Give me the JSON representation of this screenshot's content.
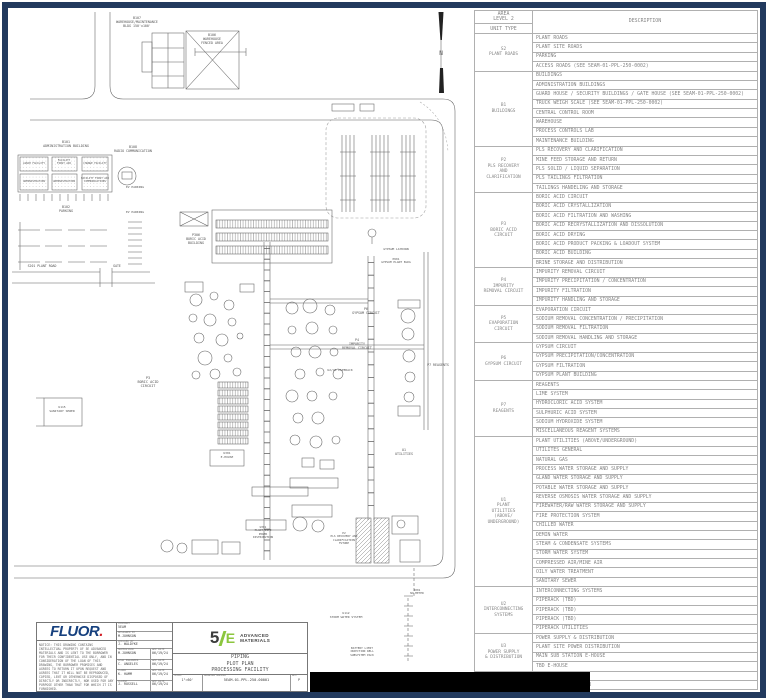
{
  "colors": {
    "frame_navy": "#223a5e",
    "fluor_blue": "#16407e",
    "fluor_red": "#d22027",
    "brand_green": "#8cc63e",
    "line_gray": "#5f5f5f",
    "table_text": "#858585",
    "redaction_black": "#000000"
  },
  "area_table": {
    "header": {
      "area_level": "AREA\nLEVEL 2",
      "unit_type": "UNIT TYPE",
      "description": "DESCRIPTION"
    },
    "groups": [
      {
        "unit": "S2\nPLANT ROADS",
        "rows": [
          "PLANT ROADS",
          "PLANT SITE ROADS",
          "PARKING",
          "ACCESS ROADS (SEE 5EAM-01-PPL-250-0002)"
        ]
      },
      {
        "unit": "B1\nBUILDINGS",
        "rows": [
          "BUILDINGS",
          "ADMINISTRATION BUILDINGS",
          "GUARD HOUSE / SECURITY BUILDINGS / GATE HOUSE (SEE 5EAM-01-PPL-250-0002)",
          "TRUCK WEIGH SCALE (SEE 5EAM-01-PPL-250-0002)",
          "CENTRAL CONTROL ROOM",
          "WAREHOUSE",
          "PROCESS CONTROLS LAB",
          "MAINTENANCE BUILDING"
        ]
      },
      {
        "unit": "P2\nPLS RECOVERY\nAND\nCLARIFICATION",
        "rows": [
          "PLS RECOVERY AND CLARIFICATION",
          "MINE FEED STORAGE AND RETURN",
          "PLS SOLID / LIQUID SEPARATION",
          "PLS TAILINGS FILTRATION",
          "TAILINGS HANDELING AND STORAGE"
        ]
      },
      {
        "unit": "P3\nBORIC ACID\nCIRCUIT",
        "rows": [
          "BORIC ACID CIRCUIT",
          "BORIC ACID CRYSTALLIZATION",
          "BORIC ACID FILTRATION AND WASHING",
          "BORIC ACID RECRYSTALLIZATION AND DISSOLUTION",
          "BORIC ACID DRYING",
          "BORIC ACID PRODUCT PACKING & LOADOUT SYSTEM",
          "BORIC ACID BUILDING",
          "BRINE STORAGE AND DISTRIBUTION"
        ]
      },
      {
        "unit": "P4\nIMPURITY\nREMOVAL CIRCUIT",
        "rows": [
          "IMPURITY REMOVAL CIRCUIT",
          "IMPURITY PRECIPITATION / CONCENTRATION",
          "IMPURITY FILTRATION",
          "IMPURITY HANDLING AND STORAGE"
        ]
      },
      {
        "unit": "P5\nEVAPORATION\nCIRCUIT",
        "rows": [
          "EVAPORATION CIRCUIT",
          "SODIUM REMOVAL CONCENTRATION / PRECIPITATION",
          "SODIUM REMOVAL FILTRATION",
          "SODIUM REMOVAL HANDLING AND STORAGE"
        ]
      },
      {
        "unit": "P6\nGYPSUM CIRCUIT",
        "rows": [
          "GYPSUM CIRCUIT",
          "GYPSUM PRECIPITATION/CONCENTRATION",
          "GYPSUM FILTRATION",
          "GYPSUM PLANT BUILDING"
        ]
      },
      {
        "unit": "P7\nREAGENTS",
        "rows": [
          "REAGENTS",
          "LIME SYSTEM",
          "HYDROCLORIC ACID SYSTEM",
          "SULPHURIC ACID SYSTEM",
          "SODIUM HYDROXIDE SYSTEM",
          "MISCELLANEOUS REAGENT SYSTEMS"
        ]
      },
      {
        "unit": "U1\nPLANT\nUTILITIES\n(ABOVE/\nUNDERGROUND)",
        "rows": [
          "PLANT UTILITIES (ABOVE/UNDERGROUND)",
          "UTILITES GENERAL",
          "NATURAL GAS",
          "PROCESS WATER STORAGE AND SUPPLY",
          "GLAND WATER STORAGE AND SUPPLY",
          "POTABLE WATER STORAGE AND SUPPLY",
          "REVERSE OSMOSIS WATER STORAGE AND SUPPLY",
          "FIREWATER/RAW WATER STORAGE AND SUPPLY",
          "FIRE PROTECTION SYSTEM",
          "CHILLED WATER",
          "DEMIN WATER",
          "STEAM & CONDENSATE SYSTEMS",
          "STORM WATER SYSTEM",
          "COMPRESSED AIR/MINE AIR",
          "OILY WATER TREATMENT",
          "SANITARY SEWER"
        ]
      },
      {
        "unit": "U2\nINTERCONNECTING\nSYSTEMS",
        "rows": [
          "INTERCONNECTING SYSTEMS",
          "PIPERACK (TBD)",
          "PIPERACK (TBD)",
          "PIPERACK (TBD)",
          "PIPERACK UTILITIES"
        ]
      },
      {
        "unit": "U3\nPOWER SUPPLY\n& DISTRIBUTION",
        "rows": [
          "POWER SUPPLY & DISTRIBUTION",
          "PLANT SITE POWER DISTRIBUTION",
          "MAIN SUB STATION E-HOUSE",
          "TBD E-HOUSE"
        ]
      },
      {
        "unit": "U4\nCOMMUNICATIONS",
        "rows": [
          "COMMUNICATIONS",
          "RADIO COMMUNICATION"
        ]
      }
    ]
  },
  "title_block": {
    "fluor_logo": "FLUOR",
    "fluor_dot": ".",
    "notice": "NOTICE: THIS DRAWING CONTAINS INTELLECTUAL PROPERTY OF 5E ADVANCED MATERIALS AND IS LENT TO THE BORROWER FOR THEIR CONFIDENTIAL USE ONLY, AND IN CONSIDERATION OF THE LOAN OF THIS DRAWING, THE BORROWER PROMISES AND AGREES TO RETURN IT UPON REQUEST AND AGREES THAT IT WILL NOT BE REPRODUCED, COPIED, LENT OR OTHERWISE DISPOSED OF DIRECTLY OR INDIRECTLY, NOR USED FOR ANY PURPOSE OTHER THAN THAT FOR WHICH IT IS FURNISHED.",
    "contract_label": "CONTRACT",
    "contract": "5EAM",
    "designed_label": "DESIGNED BY",
    "designed": "M.JOHNSON",
    "checked_label": "CHECKED BY",
    "checked": "J. WALDYKE",
    "approvals": [
      {
        "role": "SUPERVISOR",
        "name": "M.JOHNSON",
        "date_label": "APP DATE",
        "date": "06/19/24"
      },
      {
        "role": "LEAD ENGINEER",
        "name": "C. ANGELES",
        "date_label": "APP DATE",
        "date": "06/19/24"
      },
      {
        "role": "FLUOR",
        "name": "K. HAMM",
        "date_label": "APP DATE",
        "date": "06/19/24"
      },
      {
        "role": "CLIENT",
        "name": "J. RUSSELL",
        "date_label": "APP DATE",
        "date": "06/19/24"
      }
    ],
    "brand_5": "5",
    "brand_e": "E",
    "brand_name": "ADVANCED\nMATERIALS",
    "title_lines": "PIPING\nPLOT PLAN\nPROCESSING FACILITY",
    "scale_label": "SCALE",
    "scale": "1\"=60'",
    "dwg_label": "DRAWING NUMBER",
    "dwg": "5EAM-01-PPL-250-00001",
    "rev_label": "REV",
    "rev": "P"
  },
  "plot_plan": {
    "labels": [
      {
        "t": "B107\nWAREHOUSE/MAINTENANCE\nBLDG 150'x100'",
        "x": 137,
        "y": 17,
        "fs": 3.3
      },
      {
        "t": "B106\nWAREHOUSE\nFENCED AREA",
        "x": 212,
        "y": 34,
        "fs": 3.3
      },
      {
        "t": "B101\nADMINISTRATION BUILDING",
        "x": 66,
        "y": 141,
        "fs": 3.3
      },
      {
        "t": "B108\nRADIO COMMUNICATION",
        "x": 133,
        "y": 146,
        "fs": 3.3
      },
      {
        "t": "LUNCH FACILITY",
        "x": 34,
        "y": 162,
        "fs": 2.6
      },
      {
        "t": "FACILITY\nFIRST AID",
        "x": 64,
        "y": 159,
        "fs": 2.6
      },
      {
        "t": "CHANGE FACILITY",
        "x": 95,
        "y": 162,
        "fs": 2.6
      },
      {
        "t": "ADMINISTRATION",
        "x": 34,
        "y": 180,
        "fs": 2.6
      },
      {
        "t": "ADMINISTRATION",
        "x": 64,
        "y": 180,
        "fs": 2.6
      },
      {
        "t": "FACILITY FIRST AID\nCOMMUNICATIONS",
        "x": 95,
        "y": 177,
        "fs": 2.6
      },
      {
        "t": "EV PARKING",
        "x": 135,
        "y": 186,
        "fs": 3
      },
      {
        "t": "B102\nPARKING",
        "x": 66,
        "y": 206,
        "fs": 3.3
      },
      {
        "t": "EV PARKING",
        "x": 135,
        "y": 211,
        "fs": 3
      },
      {
        "t": "S201 PLANT ROAD",
        "x": 42,
        "y": 265,
        "fs": 3.2
      },
      {
        "t": "GATE",
        "x": 117,
        "y": 265,
        "fs": 3.2
      },
      {
        "t": "P306\nBORIC ACID\nBUILDING",
        "x": 196,
        "y": 234,
        "fs": 3.3
      },
      {
        "t": "GYPSUM LAYDOWN",
        "x": 396,
        "y": 248,
        "fs": 3
      },
      {
        "t": "P601\nGYPSUM PLANT BLDG",
        "x": 396,
        "y": 258,
        "fs": 2.9
      },
      {
        "t": "P3\nBORIC ACID\nCIRCUIT",
        "x": 148,
        "y": 376,
        "fs": 3.5
      },
      {
        "t": "P6\nGYPSUM CIRCUIT",
        "x": 366,
        "y": 308,
        "fs": 3.3
      },
      {
        "t": "P4\nIMPURITY\nREMOVAL CIRCUIT",
        "x": 357,
        "y": 339,
        "fs": 3.3
      },
      {
        "t": "P7 REAGENTS",
        "x": 438,
        "y": 364,
        "fs": 3.3
      },
      {
        "t": "U2/U3 PIPERACK",
        "x": 340,
        "y": 369,
        "fs": 3
      },
      {
        "t": "U1\nUTILITIES",
        "x": 404,
        "y": 449,
        "fs": 3.3
      },
      {
        "t": "U301\nE-HOUSE",
        "x": 227,
        "y": 452,
        "fs": 3
      },
      {
        "t": "U301\nPLANT SITE\nPOWER\nDISTRIBUTION",
        "x": 263,
        "y": 526,
        "fs": 2.8
      },
      {
        "t": "P2\nPLS RECOVERY AND\nCLARIFICATION\nFUTURE",
        "x": 344,
        "y": 532,
        "fs": 2.8
      },
      {
        "t": "2001\nNO METER",
        "x": 417,
        "y": 589,
        "fs": 2.8
      },
      {
        "t": "U112\nSTORM WATER SYSTEM",
        "x": 346,
        "y": 612,
        "fs": 3
      },
      {
        "t": "BATTERY LIMIT\nINJECTION WELL\nSUBSYSTEM PACK",
        "x": 362,
        "y": 647,
        "fs": 2.8
      },
      {
        "t": "U115\nSANITARY SEWER",
        "x": 62,
        "y": 406,
        "fs": 3
      },
      {
        "t": "N",
        "x": 441,
        "y": 50,
        "fs": 6
      }
    ]
  }
}
